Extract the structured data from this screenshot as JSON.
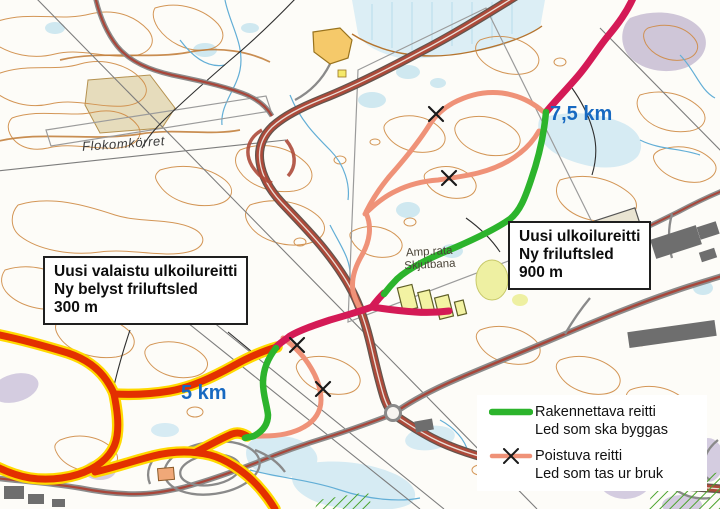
{
  "map": {
    "distance_markers": [
      {
        "label": "7,5 km"
      },
      {
        "label": "5 km"
      }
    ],
    "place_labels": {
      "bog": "Flokomkörret",
      "shooting_range_line1": "Amp.rata",
      "shooting_range_line2": "Skjutbana"
    },
    "info_boxes": [
      {
        "line1": "Uusi valaistu ulkoilureitti",
        "line2": "Ny belyst friluftsled",
        "line3": "300 m"
      },
      {
        "line1": "Uusi ulkoilureitti",
        "line2": "Ny friluftsled",
        "line3": "900 m"
      }
    ],
    "legend": {
      "items": [
        {
          "label_primary": "Rakennettava reitti",
          "label_secondary": "Led som ska byggas",
          "color": "#2cb42c",
          "symbol": "solid-line"
        },
        {
          "label_primary": "Poistuva reitti",
          "label_secondary": "Led som tas ur bruk",
          "color": "#ef9278",
          "symbol": "line-with-x"
        }
      ]
    },
    "colors": {
      "route_new": "#2cb42c",
      "route_removed": "#ef9278",
      "route_existing": "#d41a56",
      "route_lit": "#e33000",
      "route_lit_casing": "#ffd900",
      "distance_text": "#1769c1"
    }
  }
}
